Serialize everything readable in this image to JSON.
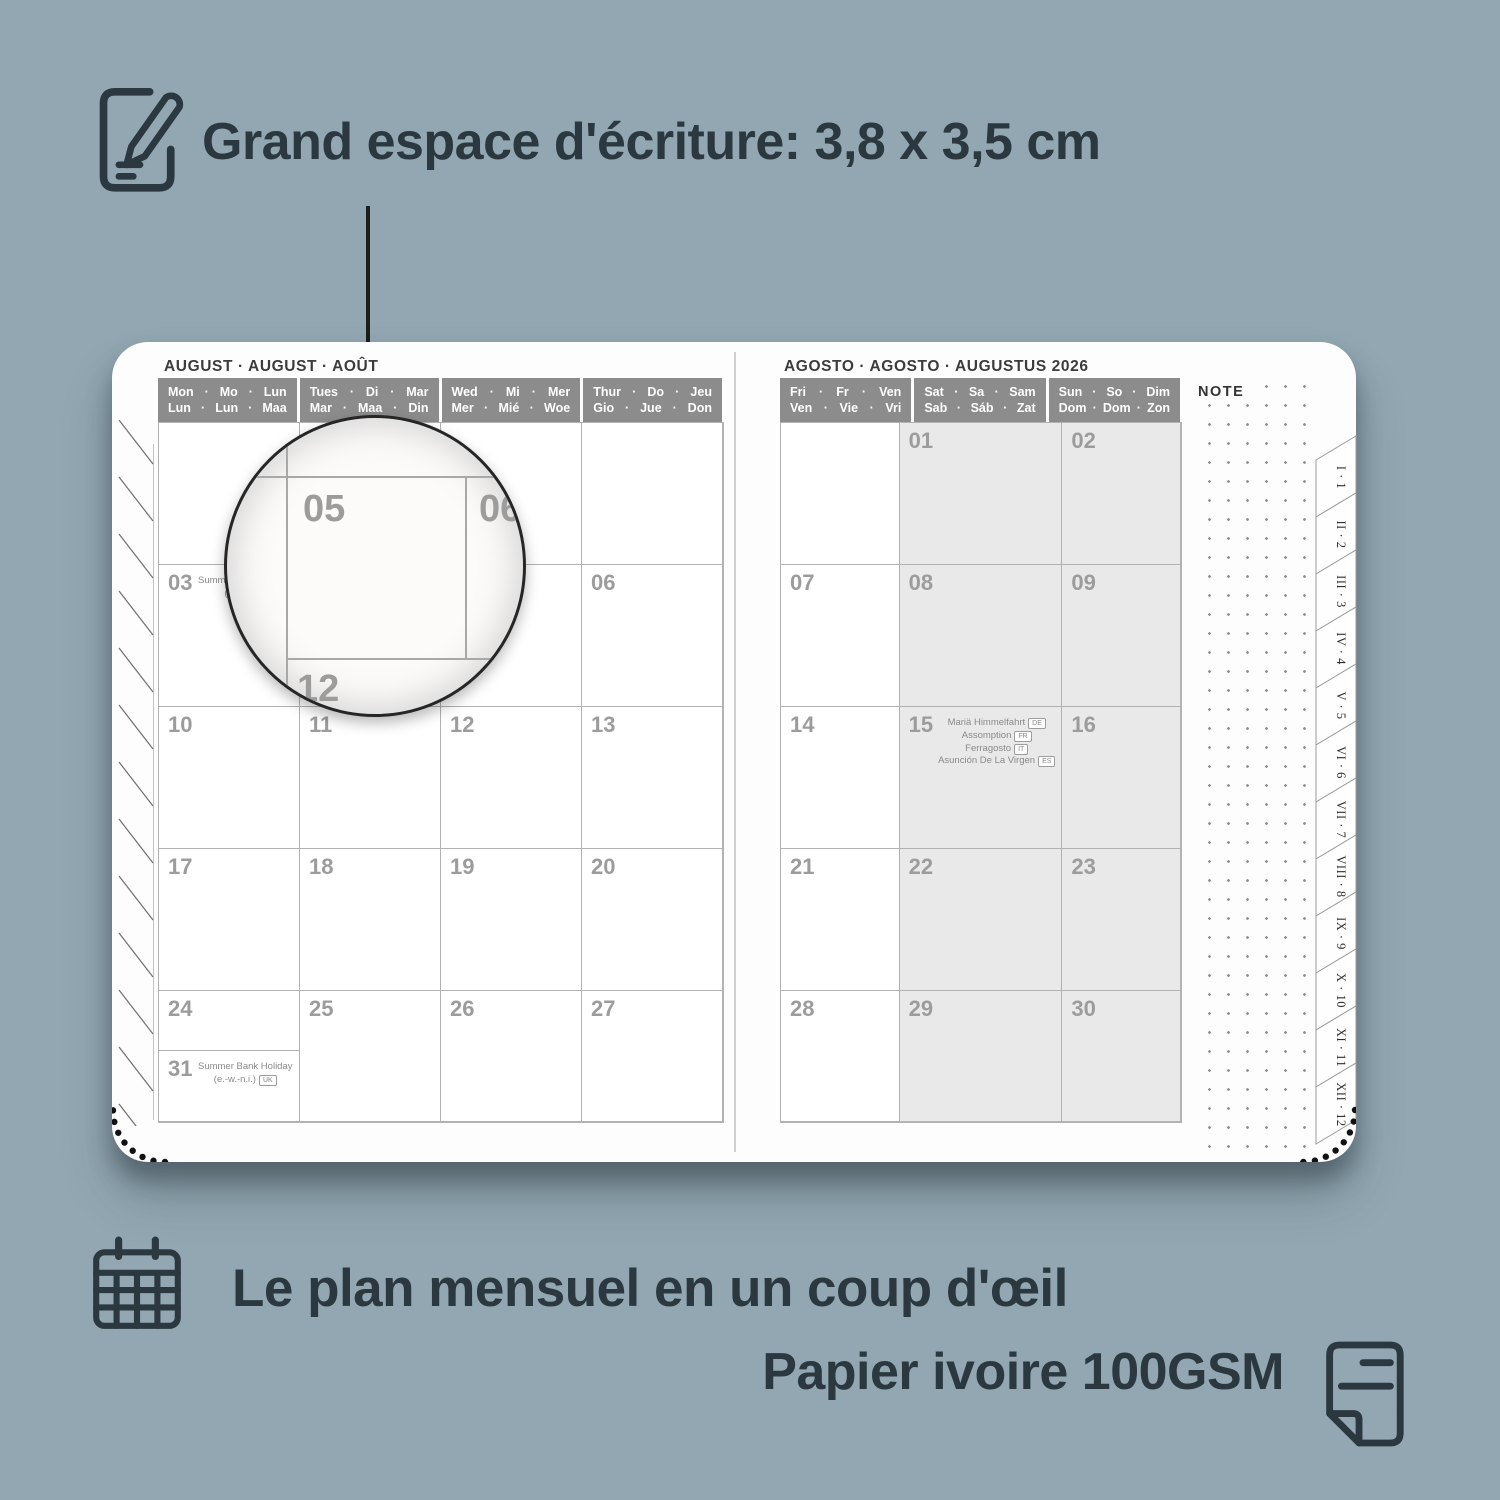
{
  "colors": {
    "background": "#92a7b2",
    "ink": "#2b3840",
    "page": "#fdfdfd",
    "header_band": "#8c8c8c",
    "grid_line": "#b2b2b2",
    "date_number": "#9c9c9c",
    "weekend_fill": "#e9e9e9"
  },
  "top_annotation": {
    "icon": "note-pencil-icon",
    "text": "Grand espace d'écriture: 3,8 x 3,5 cm"
  },
  "planner": {
    "left_page": {
      "title": "AUGUST · AUGUST · AOÛT",
      "day_headers": [
        {
          "line1": "Mon · Mo · Lun",
          "line2": "Lun · Lun · Maa",
          "weekend": false
        },
        {
          "line1": "Tues · Di · Mar",
          "line2": "Mar · Maa · Din",
          "weekend": false
        },
        {
          "line1": "Wed · Mi · Mer",
          "line2": "Mer · Mié · Woe",
          "weekend": false
        },
        {
          "line1": "Thur · Do · Jeu",
          "line2": "Gio · Jue · Don",
          "weekend": false
        }
      ],
      "weeks": [
        [
          {},
          {},
          {},
          {}
        ],
        [
          {
            "date": "03",
            "holidays": [
              {
                "text": "Summer Bank Holiday"
              },
              {
                "text": "(sct.)",
                "country": "UK"
              }
            ]
          },
          {
            "date": "04"
          },
          {
            "date": "05"
          },
          {
            "date": "06"
          }
        ],
        [
          {
            "date": "10"
          },
          {
            "date": "11"
          },
          {
            "date": "12"
          },
          {
            "date": "13"
          }
        ],
        [
          {
            "date": "17"
          },
          {
            "date": "18"
          },
          {
            "date": "19"
          },
          {
            "date": "20"
          }
        ],
        [
          {
            "date": "24"
          },
          {
            "date": "25"
          },
          {
            "date": "26"
          },
          {
            "date": "27"
          }
        ],
        [
          {
            "date": "31",
            "holidays": [
              {
                "text": "Summer Bank Holiday"
              },
              {
                "text": "(e.-w.-n.i.)",
                "country": "UK"
              }
            ]
          }
        ]
      ]
    },
    "right_page": {
      "title": "AGOSTO · AGOSTO · AUGUSTUS 2026",
      "note_label": "NOTE",
      "day_headers": [
        {
          "line1": "Fri · Fr · Ven",
          "line2": "Ven · Vie · Vri",
          "weekend": false
        },
        {
          "line1": "Sat · Sa · Sam",
          "line2": "Sab · Sáb · Zat",
          "weekend": true
        },
        {
          "line1": "Sun · So · Dim",
          "line2": "Dom · Dom · Zon",
          "weekend": true
        }
      ],
      "weeks": [
        [
          {},
          {
            "date": "01"
          },
          {
            "date": "02"
          }
        ],
        [
          {
            "date": "07"
          },
          {
            "date": "08"
          },
          {
            "date": "09"
          }
        ],
        [
          {
            "date": "14"
          },
          {
            "date": "15",
            "holidays": [
              {
                "text": "Mariä Himmelfahrt",
                "country": "DE"
              },
              {
                "text": "Assomption",
                "country": "FR"
              },
              {
                "text": "Ferragosto",
                "country": "IT"
              },
              {
                "text": "Asunción De La Virgen",
                "country": "ES"
              }
            ]
          },
          {
            "date": "16"
          }
        ],
        [
          {
            "date": "21"
          },
          {
            "date": "22"
          },
          {
            "date": "23"
          }
        ],
        [
          {
            "date": "28"
          },
          {
            "date": "29"
          },
          {
            "date": "30"
          }
        ]
      ]
    },
    "month_tabs": [
      "I · 1",
      "II · 2",
      "III · 3",
      "IV · 4",
      "V · 5",
      "VI · 6",
      "VII · 7",
      "VIII · 8",
      "IX · 9",
      "X · 10",
      "XI · 11",
      "XII · 12"
    ]
  },
  "magnifier": {
    "cell_date": "05",
    "next_cell_date": "06",
    "below_cell_date": "12"
  },
  "bottom_annotations": {
    "monthly": {
      "icon": "calendar-grid-icon",
      "text": "Le plan mensuel en un coup d'œil"
    },
    "paper": {
      "icon": "paper-sheet-icon",
      "text": "Papier ivoire 100GSM"
    }
  }
}
